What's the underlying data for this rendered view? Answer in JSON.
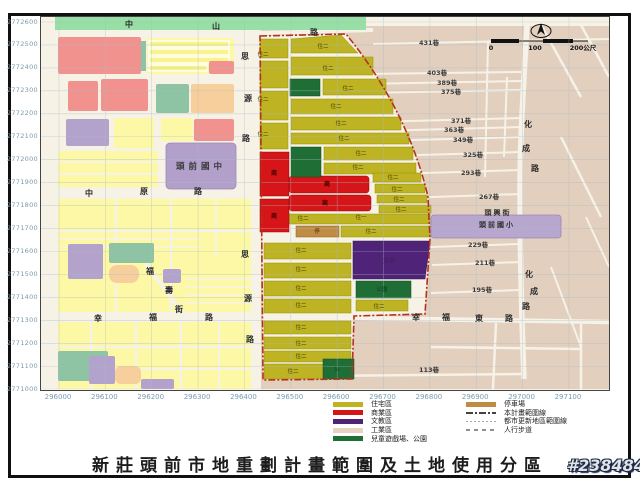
{
  "title": "新莊頭前市地重劃計畫範圍及土地使用分區",
  "watermark": "#2384846",
  "axes": {
    "x_labels": [
      "296000",
      "296100",
      "296200",
      "296300",
      "296400",
      "296500",
      "296600",
      "296700",
      "296800",
      "296900",
      "297000",
      "297100"
    ],
    "y_labels": [
      "2772600",
      "2772500",
      "2772400",
      "2772300",
      "2772200",
      "2772100",
      "2772000",
      "2771900",
      "2771800",
      "2771700",
      "2771600",
      "2771500",
      "2771400",
      "2771300",
      "2771200",
      "2771100",
      "2771000"
    ]
  },
  "legend": {
    "zones": [
      {
        "label": "住宅區",
        "color": "#bdb323"
      },
      {
        "label": "商業區",
        "color": "#d61518"
      },
      {
        "label": "文教區",
        "color": "#4f2377"
      },
      {
        "label": "工業區",
        "color": "#e6d3c3"
      },
      {
        "label": "兒童遊戲場、公園",
        "color": "#1e6e35"
      }
    ],
    "lines": [
      {
        "label": "停車場",
        "kind": "swatch",
        "color": "#c08b42"
      },
      {
        "label": "本計畫範圍線",
        "kind": "dashdot"
      },
      {
        "label": "都市更新地區範圍線",
        "kind": "dotted"
      },
      {
        "label": "人行步道",
        "kind": "dashed"
      }
    ]
  },
  "colors": {
    "residential": "#bdb323",
    "commercial": "#d61518",
    "cultural": "#4f2377",
    "industrial": "#e2cfbe",
    "park": "#1e6e35",
    "parking": "#c08b42",
    "boundary": "#b5311f"
  },
  "map": {
    "labels": [
      {
        "t": "中",
        "x": 88,
        "y": 10,
        "k": "road"
      },
      {
        "t": "山",
        "x": 175,
        "y": 12,
        "k": "road"
      },
      {
        "t": "路",
        "x": 273,
        "y": 18,
        "k": "road"
      },
      {
        "t": "思",
        "x": 204,
        "y": 42,
        "k": "road"
      },
      {
        "t": "源",
        "x": 207,
        "y": 84,
        "k": "road"
      },
      {
        "t": "路",
        "x": 205,
        "y": 124,
        "k": "road"
      },
      {
        "t": "中",
        "x": 48,
        "y": 179,
        "k": "road"
      },
      {
        "t": "原",
        "x": 103,
        "y": 177,
        "k": "road"
      },
      {
        "t": "路",
        "x": 157,
        "y": 177,
        "k": "road"
      },
      {
        "t": "思",
        "x": 204,
        "y": 240,
        "k": "road"
      },
      {
        "t": "源",
        "x": 207,
        "y": 284,
        "k": "road"
      },
      {
        "t": "路",
        "x": 209,
        "y": 325,
        "k": "road"
      },
      {
        "t": "幸",
        "x": 57,
        "y": 304,
        "k": "road"
      },
      {
        "t": "福",
        "x": 112,
        "y": 303,
        "k": "road"
      },
      {
        "t": "路",
        "x": 168,
        "y": 303,
        "k": "road"
      },
      {
        "t": "福",
        "x": 109,
        "y": 257,
        "k": "road"
      },
      {
        "t": "壽",
        "x": 128,
        "y": 276,
        "k": "road"
      },
      {
        "t": "街",
        "x": 138,
        "y": 295,
        "k": "road"
      },
      {
        "t": "幸",
        "x": 375,
        "y": 303,
        "k": "road"
      },
      {
        "t": "福",
        "x": 405,
        "y": 303,
        "k": "road"
      },
      {
        "t": "東",
        "x": 438,
        "y": 304,
        "k": "road"
      },
      {
        "t": "路",
        "x": 468,
        "y": 304,
        "k": "road"
      },
      {
        "t": "化",
        "x": 487,
        "y": 110,
        "k": "road"
      },
      {
        "t": "成",
        "x": 485,
        "y": 134,
        "k": "road"
      },
      {
        "t": "路",
        "x": 494,
        "y": 154,
        "k": "road"
      },
      {
        "t": "化",
        "x": 488,
        "y": 260,
        "k": "road"
      },
      {
        "t": "成",
        "x": 493,
        "y": 277,
        "k": "road"
      },
      {
        "t": "路",
        "x": 485,
        "y": 292,
        "k": "road"
      },
      {
        "t": "431巷",
        "x": 388,
        "y": 28,
        "k": "lane"
      },
      {
        "t": "403巷",
        "x": 396,
        "y": 58,
        "k": "lane"
      },
      {
        "t": "389巷",
        "x": 406,
        "y": 68,
        "k": "lane"
      },
      {
        "t": "375巷",
        "x": 410,
        "y": 77,
        "k": "lane"
      },
      {
        "t": "371巷",
        "x": 420,
        "y": 106,
        "k": "lane"
      },
      {
        "t": "363巷",
        "x": 413,
        "y": 115,
        "k": "lane"
      },
      {
        "t": "349巷",
        "x": 422,
        "y": 125,
        "k": "lane"
      },
      {
        "t": "325巷",
        "x": 432,
        "y": 140,
        "k": "lane"
      },
      {
        "t": "293巷",
        "x": 430,
        "y": 158,
        "k": "lane"
      },
      {
        "t": "267巷",
        "x": 448,
        "y": 182,
        "k": "lane"
      },
      {
        "t": "229巷",
        "x": 437,
        "y": 230,
        "k": "lane"
      },
      {
        "t": "211巷",
        "x": 444,
        "y": 248,
        "k": "lane"
      },
      {
        "t": "195巷",
        "x": 441,
        "y": 275,
        "k": "lane"
      },
      {
        "t": "113巷",
        "x": 388,
        "y": 355,
        "k": "lane"
      },
      {
        "t": "住二",
        "x": 222,
        "y": 39,
        "k": "zone"
      },
      {
        "t": "住二",
        "x": 222,
        "y": 84,
        "k": "zone"
      },
      {
        "t": "住二",
        "x": 222,
        "y": 119,
        "k": "zone"
      },
      {
        "t": "住二",
        "x": 282,
        "y": 31,
        "k": "zone"
      },
      {
        "t": "住二",
        "x": 287,
        "y": 53,
        "k": "zone"
      },
      {
        "t": "住二",
        "x": 307,
        "y": 73,
        "k": "zone"
      },
      {
        "t": "住二",
        "x": 295,
        "y": 91,
        "k": "zone"
      },
      {
        "t": "住二",
        "x": 300,
        "y": 108,
        "k": "zone"
      },
      {
        "t": "住二",
        "x": 303,
        "y": 123,
        "k": "zone"
      },
      {
        "t": "住二",
        "x": 320,
        "y": 138,
        "k": "zone"
      },
      {
        "t": "住二",
        "x": 317,
        "y": 152,
        "k": "zone"
      },
      {
        "t": "住二",
        "x": 352,
        "y": 162,
        "k": "zone"
      },
      {
        "t": "住二",
        "x": 356,
        "y": 174,
        "k": "zone"
      },
      {
        "t": "住二",
        "x": 358,
        "y": 184,
        "k": "zone"
      },
      {
        "t": "住二",
        "x": 360,
        "y": 194,
        "k": "zone"
      },
      {
        "t": "住二",
        "x": 262,
        "y": 203,
        "k": "zone"
      },
      {
        "t": "住一",
        "x": 320,
        "y": 202,
        "k": "zone"
      },
      {
        "t": "住二",
        "x": 330,
        "y": 216,
        "k": "zone"
      },
      {
        "t": "住二",
        "x": 260,
        "y": 235,
        "k": "zone"
      },
      {
        "t": "住二",
        "x": 260,
        "y": 254,
        "k": "zone"
      },
      {
        "t": "住二",
        "x": 260,
        "y": 273,
        "k": "zone"
      },
      {
        "t": "住二",
        "x": 260,
        "y": 290,
        "k": "zone"
      },
      {
        "t": "住二",
        "x": 260,
        "y": 312,
        "k": "zone"
      },
      {
        "t": "住二",
        "x": 260,
        "y": 328,
        "k": "zone"
      },
      {
        "t": "住二",
        "x": 260,
        "y": 341,
        "k": "zone"
      },
      {
        "t": "住二",
        "x": 252,
        "y": 356,
        "k": "zone"
      },
      {
        "t": "住二",
        "x": 338,
        "y": 291,
        "k": "zone"
      },
      {
        "t": "商",
        "x": 233,
        "y": 158,
        "k": "red"
      },
      {
        "t": "商",
        "x": 233,
        "y": 201,
        "k": "red"
      },
      {
        "t": "商",
        "x": 286,
        "y": 169,
        "k": "red"
      },
      {
        "t": "商",
        "x": 284,
        "y": 188,
        "k": "red"
      },
      {
        "t": "停",
        "x": 276,
        "y": 216,
        "k": "brown"
      },
      {
        "t": "文中",
        "x": 348,
        "y": 246,
        "k": "purple"
      },
      {
        "t": "公園",
        "x": 341,
        "y": 274,
        "k": "green"
      },
      {
        "t": "公",
        "x": 296,
        "y": 354,
        "k": "green"
      },
      {
        "t": "頭興街",
        "x": 457,
        "y": 198,
        "k": "place"
      },
      {
        "t": "頭前國小",
        "x": 456,
        "y": 210,
        "k": "place"
      },
      {
        "t": "頭前國中",
        "x": 160,
        "y": 152,
        "k": "school"
      },
      {
        "t": "0",
        "x": 450,
        "y": 33,
        "k": "scale"
      },
      {
        "t": "100",
        "x": 494,
        "y": 33,
        "k": "scale"
      },
      {
        "t": "200公尺",
        "x": 542,
        "y": 33,
        "k": "scale"
      }
    ]
  }
}
